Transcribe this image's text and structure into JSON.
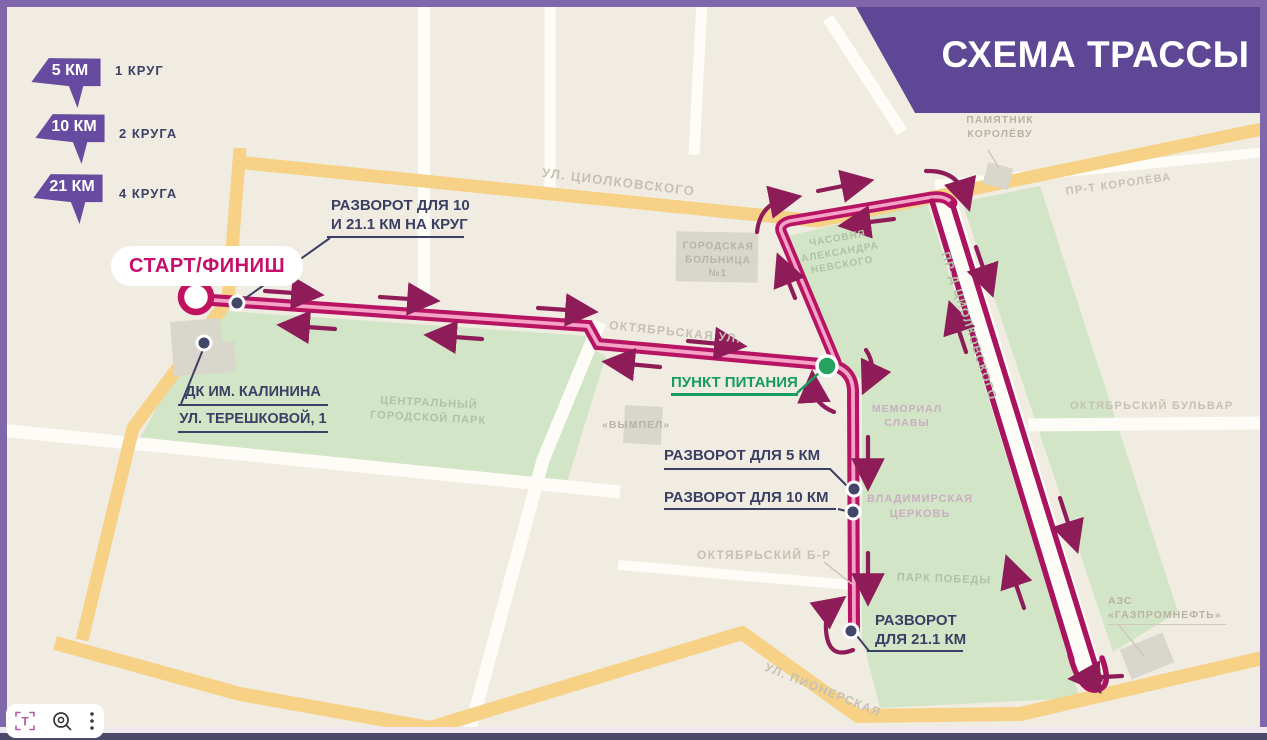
{
  "title": "СХЕМА ТРАССЫ",
  "legend": [
    {
      "distance": "5 КМ",
      "laps": "1 КРУГ"
    },
    {
      "distance": "10 КМ",
      "laps": "2 КРУГА"
    },
    {
      "distance": "21 КМ",
      "laps": "4 КРУГА"
    }
  ],
  "route": {
    "start_finish": "СТАРТ/ФИНИШ",
    "turnaround_loop_line1": "РАЗВОРОТ ДЛЯ 10",
    "turnaround_loop_line2": "И 21.1 КМ НА КРУГ",
    "venue_line1": "ДК ИМ. КАЛИНИНА",
    "venue_line2": "УЛ. ТЕРЕШКОВОЙ, 1",
    "food_station": "ПУНКТ ПИТАНИЯ",
    "turnaround_5k": "РАЗВОРОТ ДЛЯ 5 КМ",
    "turnaround_10k": "РАЗВОРОТ ДЛЯ 10 КМ",
    "turnaround_21k_line1": "РАЗВОРОТ",
    "turnaround_21k_line2": "ДЛЯ 21.1 КМ"
  },
  "streets": {
    "tsiolkovskogo": "УЛ. ЦИОЛКОВСКОГО",
    "oktyabrskaya": "ОКТЯБРЬСКАЯ УЛ.",
    "proezd_tsiolkovskogo": "ПР-Д ЦИОЛКОВСКОГО",
    "prospekt_koroleva": "ПР-Т КОРОЛЁВА",
    "oktyabrsky_bulvar": "ОКТЯБРЬСКИЙ БУЛЬВАР",
    "oktyabrsky_br": "ОКТЯБРЬСКИЙ Б-Р",
    "pionerskaya": "УЛ. ПИОНЕРСКАЯ"
  },
  "places": {
    "pamyatnik_line1": "ПАМЯТНИК",
    "pamyatnik_line2": "КОРОЛЁВУ",
    "bolnitsa_line1": "ГОРОДСКАЯ",
    "bolnitsa_line2": "БОЛЬНИЦА №1",
    "chasovnya_line1": "ЧАСОВНЯ",
    "chasovnya_line2": "АЛЕКСАНДРА",
    "chasovnya_line3": "НЕВСКОГО",
    "central_park_line1": "ЦЕНТРАЛЬНЫЙ",
    "central_park_line2": "ГОРОДСКОЙ ПАРК",
    "vympel": "«ВЫМПЕЛ»",
    "memorial_line1": "МЕМОРИАЛ",
    "memorial_line2": "СЛАВЫ",
    "tserkov_line1": "ВЛАДИМИРСКАЯ",
    "tserkov_line2": "ЦЕРКОВЬ",
    "park_pobedy": "ПАРК ПОБЕДЫ",
    "azs_line1": "АЗС",
    "azs_line2": "«ГАЗПРОМНЕФТЬ»"
  },
  "toolbar": {
    "icons": [
      "text-recognition",
      "search-zoom",
      "menu"
    ],
    "t_glyph": "T"
  },
  "colors": {
    "accent_purple": "#5e4795",
    "frame_purple": "#8066ab",
    "route_magenta": "#b71464",
    "route_pink": "#f6a3c8",
    "arrow_maroon": "#8e1c58",
    "food_green": "#27a15f",
    "label_navy": "#3a3f63",
    "road_yellow": "#f6d186",
    "park_green": "#d2e5c6"
  }
}
